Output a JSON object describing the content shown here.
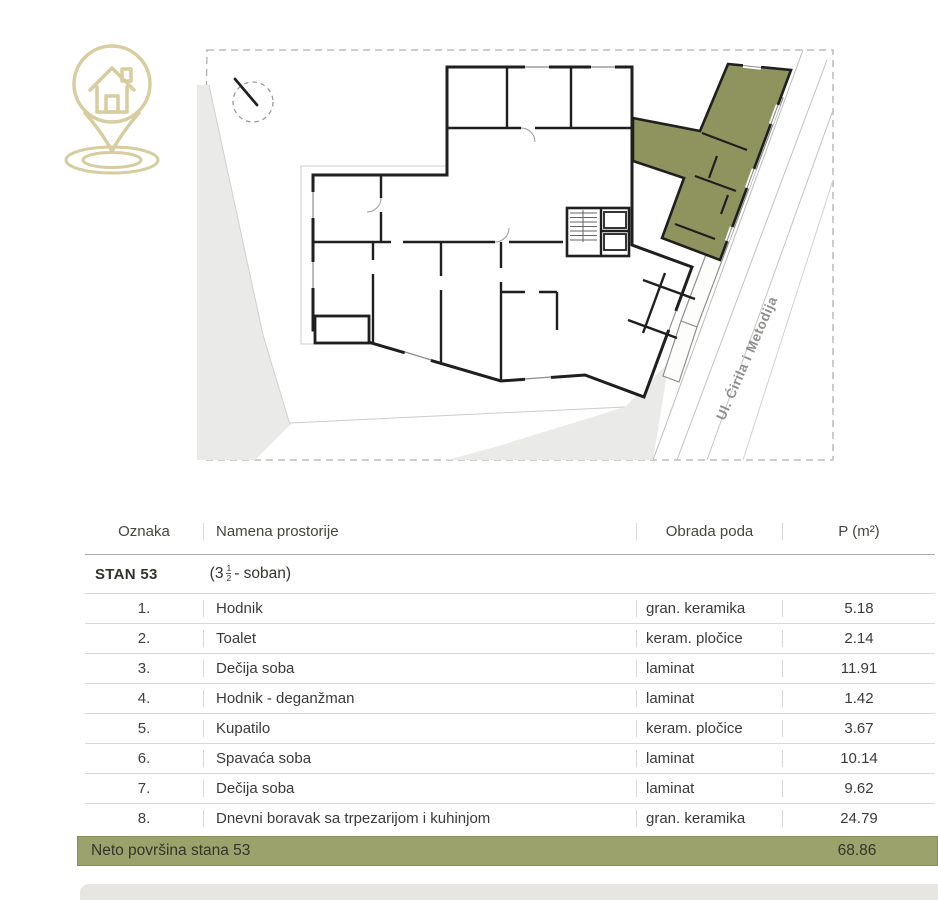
{
  "page": {
    "background": "#ffffff"
  },
  "logo": {
    "icon": "house-location-pin-logo",
    "color": "#d9cc9e"
  },
  "plan": {
    "street_label": "Ul. Ćirila i Metodija",
    "colors": {
      "highlight_unit": "#8f945e",
      "walls": "#1f1f1f",
      "parcel_gray": "#eaeae8",
      "boundary_dash": "#b0b0ae"
    }
  },
  "table": {
    "headers": {
      "oznaka": "Oznaka",
      "namena": "Namena prostorije",
      "obrada": "Obrada poda",
      "p": "P (m²)"
    },
    "group": {
      "label": "STAN 53",
      "paren_open": "(3",
      "frac_num": "1",
      "frac_den": "2",
      "paren_close": "- soban)"
    },
    "rows": [
      {
        "num": "1.",
        "name": "Hodnik",
        "floor": "gran. keramika",
        "area": "5.18"
      },
      {
        "num": "2.",
        "name": "Toalet",
        "floor": "keram. pločice",
        "area": "2.14"
      },
      {
        "num": "3.",
        "name": "Dečija soba",
        "floor": "laminat",
        "area": "11.91"
      },
      {
        "num": "4.",
        "name": "Hodnik - deganžman",
        "floor": "laminat",
        "area": "1.42"
      },
      {
        "num": "5.",
        "name": "Kupatilo",
        "floor": "keram. pločice",
        "area": "3.67"
      },
      {
        "num": "6.",
        "name": "Spavaća soba",
        "floor": "laminat",
        "area": "10.14"
      },
      {
        "num": "7.",
        "name": "Dečija soba",
        "floor": "laminat",
        "area": "9.62"
      },
      {
        "num": "8.",
        "name": "Dnevni boravak sa trpezarijom i kuhinjom",
        "floor": "gran. keramika",
        "area": "24.79"
      }
    ],
    "footer": {
      "label": "Neto površina stana 53",
      "value": "68.86",
      "color": "#9ca26c"
    }
  }
}
